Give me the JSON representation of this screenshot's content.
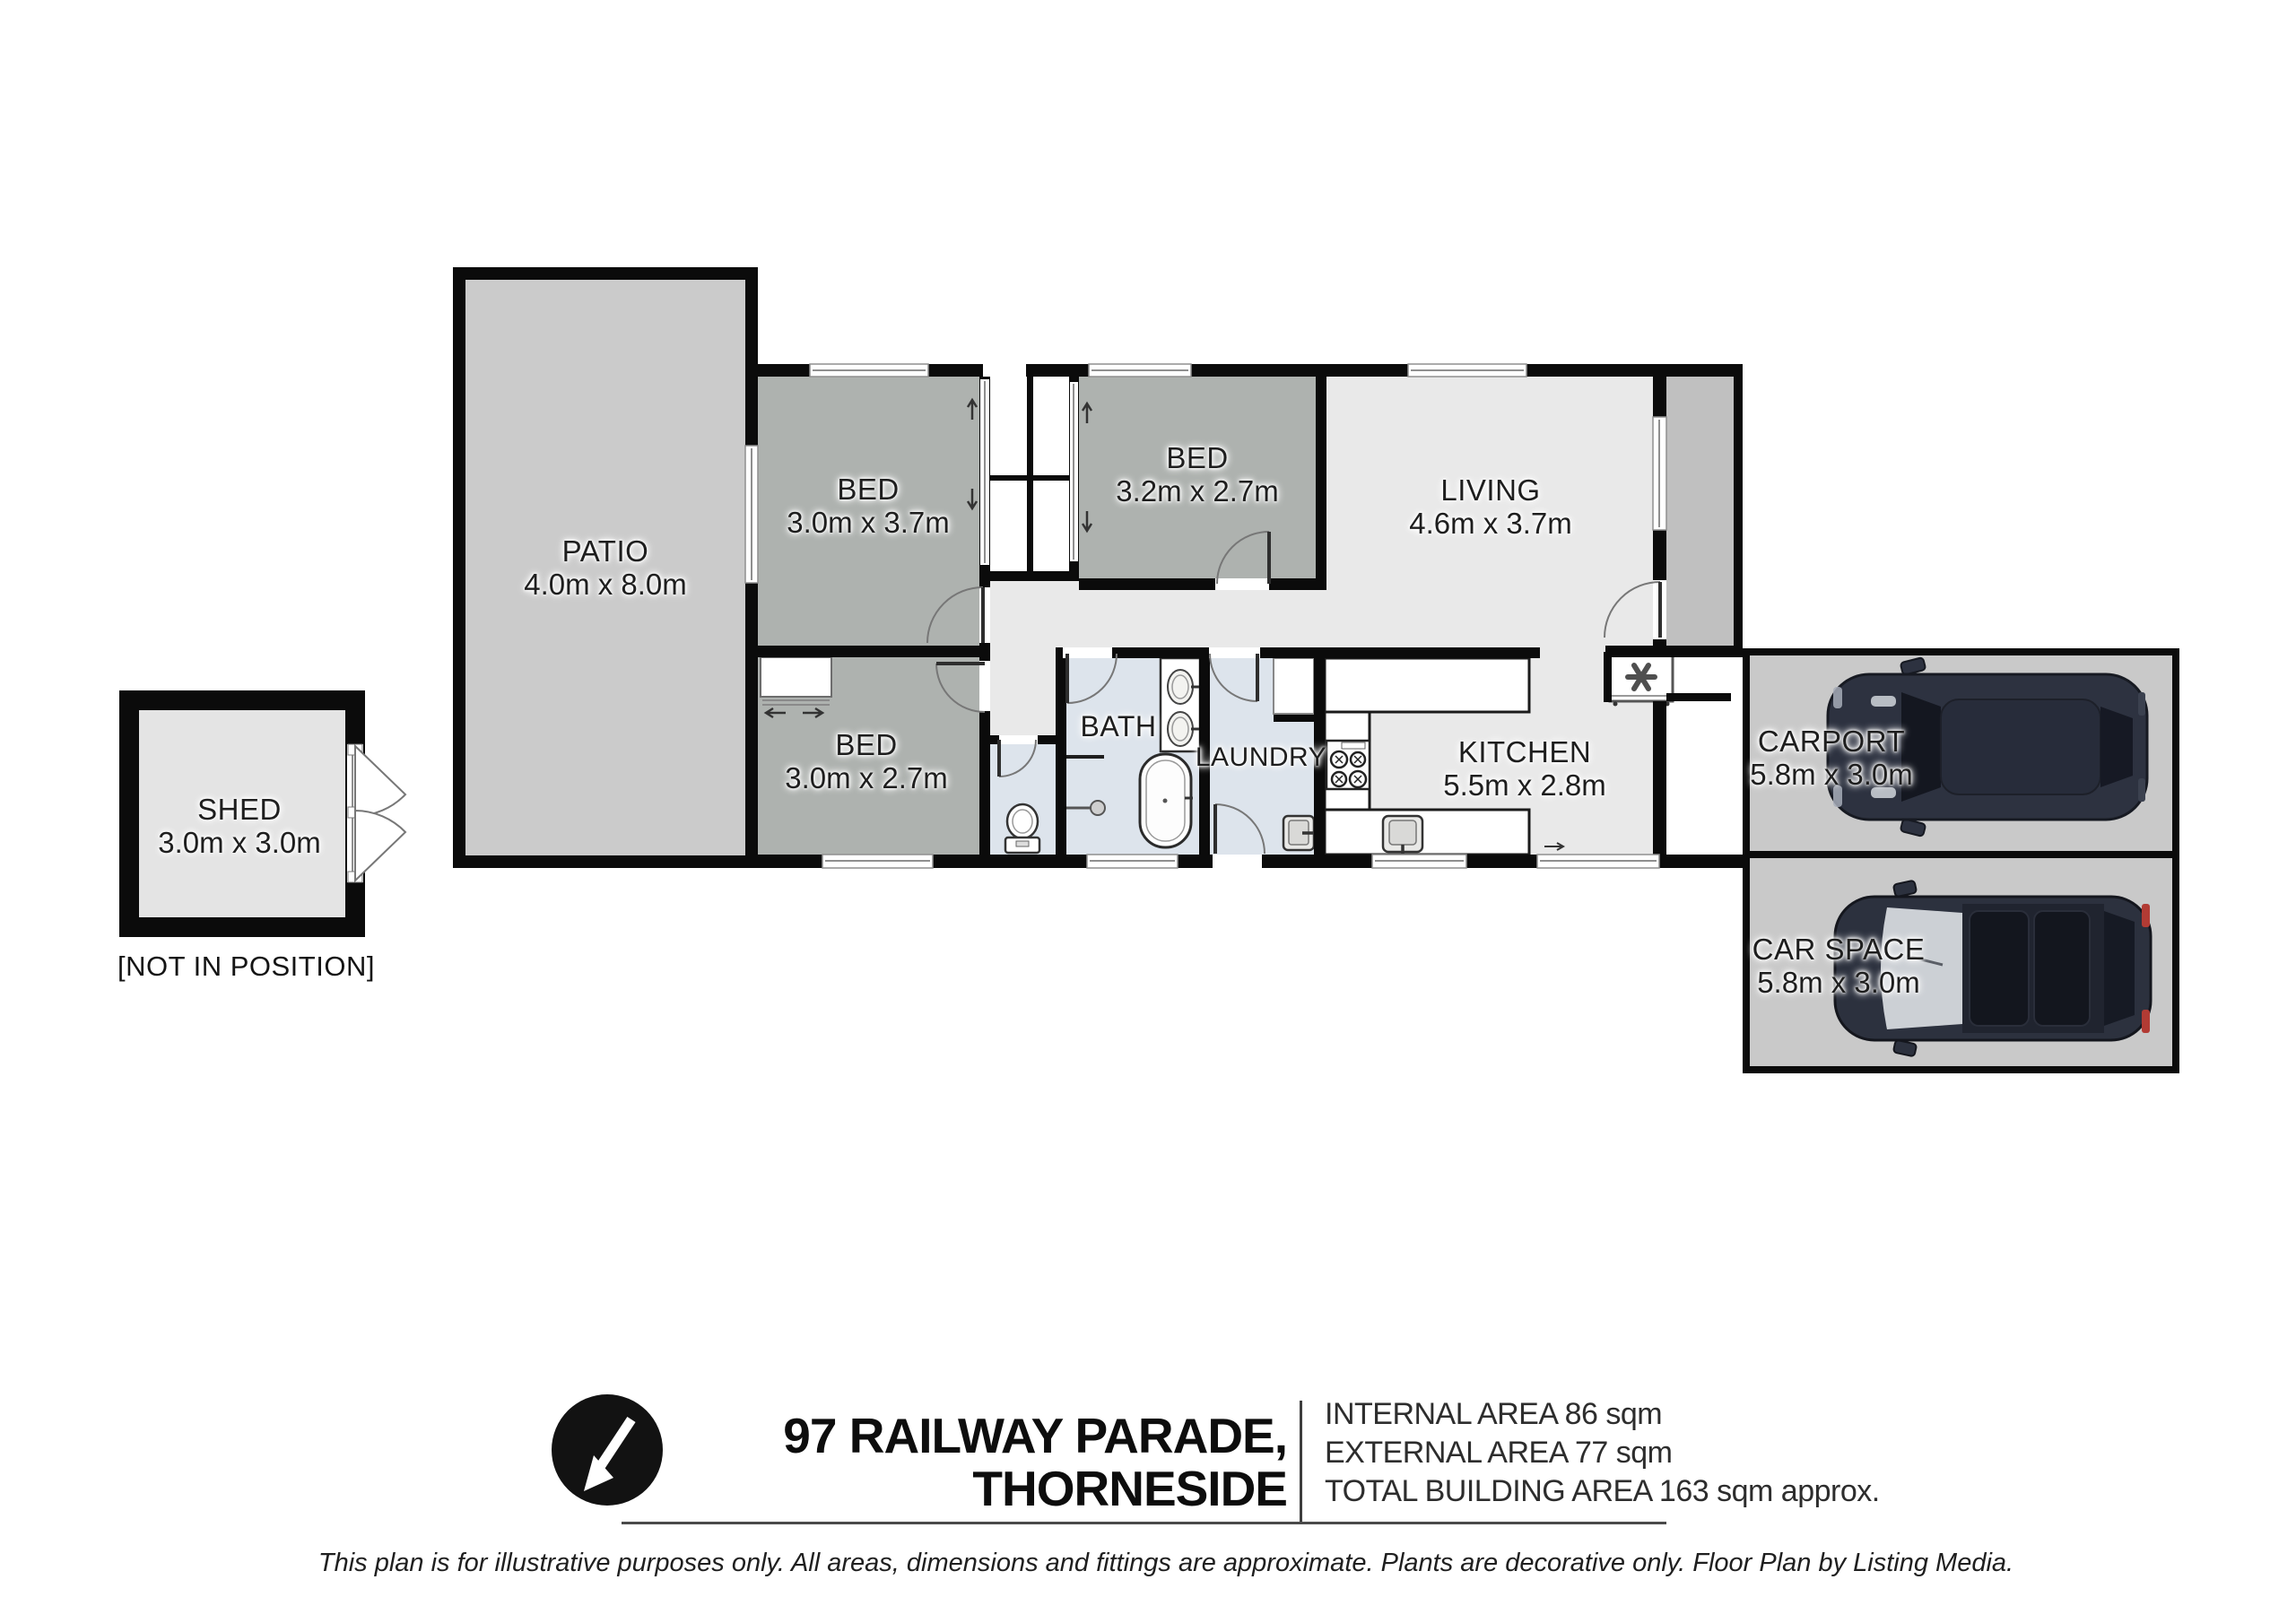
{
  "rooms": {
    "patio": {
      "name": "PATIO",
      "dims": "4.0m x 8.0m"
    },
    "bed1": {
      "name": "BED",
      "dims": "3.0m x 3.7m"
    },
    "bed2": {
      "name": "BED",
      "dims": "3.2m x 2.7m"
    },
    "living": {
      "name": "LIVING",
      "dims": "4.6m x 3.7m"
    },
    "bed3": {
      "name": "BED",
      "dims": "3.0m x 2.7m"
    },
    "bath": {
      "name": "BATH"
    },
    "laundry": {
      "name": "LAUNDRY"
    },
    "kitchen": {
      "name": "KITCHEN",
      "dims": "5.5m x 2.8m"
    },
    "carport": {
      "name": "CARPORT",
      "dims": "5.8m x 3.0m"
    },
    "car_space": {
      "name": "CAR SPACE",
      "dims": "5.8m x 3.0m"
    },
    "shed": {
      "name": "SHED",
      "dims": "3.0m x 3.0m",
      "note": "[NOT IN POSITION]"
    }
  },
  "footer": {
    "address_line1": "97 RAILWAY PARADE,",
    "address_line2": "THORNESIDE",
    "internal_area": "INTERNAL AREA 86 sqm",
    "external_area": "EXTERNAL AREA 77 sqm",
    "total_area": "TOTAL BUILDING AREA 163 sqm approx.",
    "disclaimer": "This plan is for illustrative purposes only. All areas, dimensions and fittings are approximate. Plants are decorative only. Floor Plan by Listing Media."
  },
  "colors": {
    "wall": "#0b0b0b",
    "bedroom_fill": "#aeb2af",
    "living_fill": "#e9e9e9",
    "wet_area_fill": "#dde4ec",
    "outdoor_fill": "#cbcbcb",
    "carport_fill": "#c9c9c9",
    "car_body": "#2d3240"
  }
}
